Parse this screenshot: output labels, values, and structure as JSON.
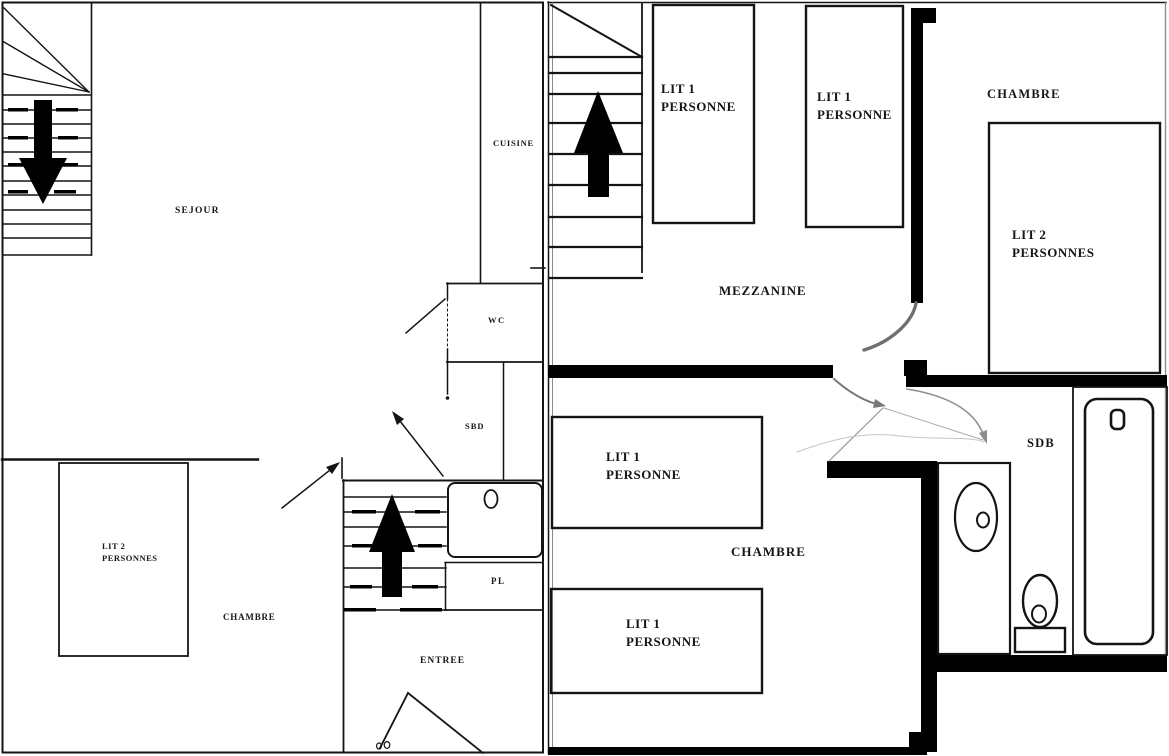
{
  "plans": {
    "ground": {
      "rooms": {
        "sejour": {
          "label": "SEJOUR"
        },
        "cuisine": {
          "label": "CUISINE"
        },
        "wc": {
          "label": "WC"
        },
        "sbd": {
          "label": "SBD"
        },
        "pl": {
          "label": "PL"
        },
        "entree": {
          "label": "ENTREE"
        },
        "chambre": {
          "label": "CHAMBRE"
        }
      },
      "furniture": {
        "bed_double": {
          "label": "LIT 2\nPERSONNES"
        }
      },
      "icons": {
        "stairs_down": "down-arrow",
        "stairs_up": "up-arrow"
      }
    },
    "upper": {
      "rooms": {
        "mezzanine": {
          "label": "MEZZANINE"
        },
        "chambre_top": {
          "label": "CHAMBRE"
        },
        "chambre_bottom": {
          "label": "CHAMBRE"
        },
        "sdb": {
          "label": "SDB"
        }
      },
      "furniture": {
        "bed_single_mezz_left": {
          "label": "LIT 1\nPERSONNE"
        },
        "bed_single_mezz_right": {
          "label": "LIT 1\nPERSONNE"
        },
        "bed_double_top": {
          "label": "LIT 2\nPERSONNES"
        },
        "bed_single_low_top": {
          "label": "LIT 1\nPERSONNE"
        },
        "bed_single_low_bottom": {
          "label": "LIT 1\nPERSONNE"
        }
      },
      "icons": {
        "stairs_up": "up-arrow"
      }
    }
  },
  "colors": {
    "background": "#ffffff",
    "line": "#141414",
    "wall": "#000000",
    "door_swing": "#7a7a7a",
    "faint": "#bdbdbd"
  }
}
